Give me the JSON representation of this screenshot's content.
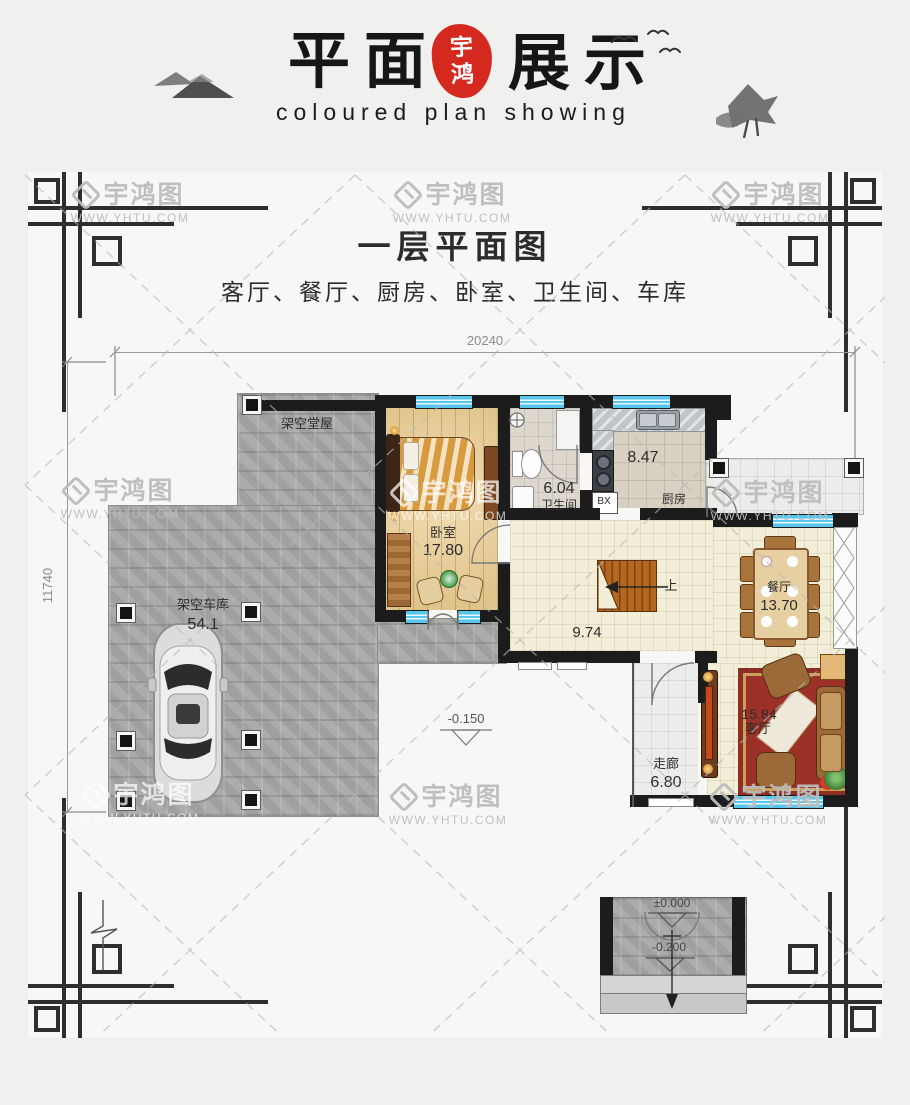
{
  "header": {
    "brand_cn_left": "平面",
    "brand_cn_right": "展示",
    "seal_char_top": "宇",
    "seal_char_bottom": "鸿",
    "tagline": "coloured plan showing"
  },
  "plan": {
    "title": "一层平面图",
    "subtitle": "客厅、餐厅、厨房、卧室、卫生间、车库",
    "dimensions": {
      "top": "20240",
      "left": "11740"
    },
    "level_marker": "-0.150",
    "stairs_label": "上",
    "fridge_label": "BX",
    "rooms": {
      "bedroom": {
        "name": "卧室",
        "area": "17.80"
      },
      "bathroom": {
        "name": "卫生间",
        "area": "6.04"
      },
      "kitchen": {
        "name": "厨房",
        "area": "8.47"
      },
      "dining": {
        "name": "餐厅",
        "area": "13.70"
      },
      "living": {
        "name": "客厅",
        "area": "15.84"
      },
      "corridor": {
        "name": "走廊",
        "area": "6.80"
      },
      "garage": {
        "name": "架空车库",
        "area": "54.1"
      },
      "stilt_hall": {
        "name": "架空堂屋"
      },
      "hall": {
        "area": "9.74"
      }
    }
  },
  "porch_detail": {
    "level_zero": "±0.000",
    "level_minus": "-0.200"
  },
  "watermark": {
    "logo_text": "宇鸿图",
    "url": "WWW.YHTU.COM"
  },
  "colors": {
    "seal_red": "#d5281e",
    "window_blue": "#58c5ec",
    "wall_black": "#1c1c1c"
  }
}
